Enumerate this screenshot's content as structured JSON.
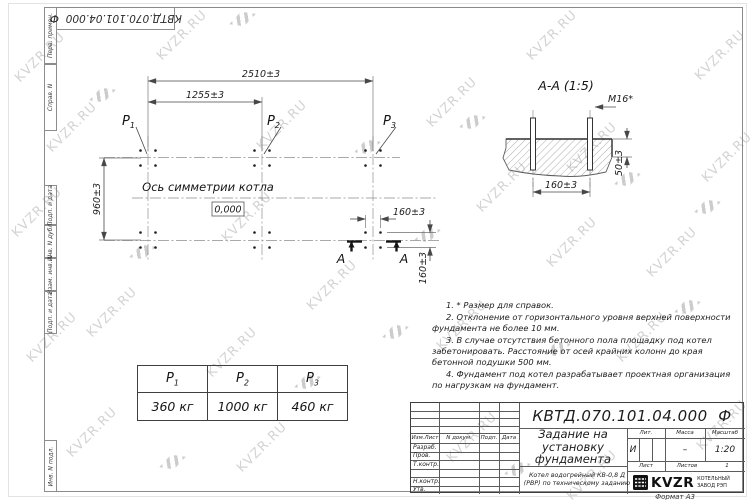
{
  "document": {
    "doc_number": "КВТД.070.101.04.000  Ф",
    "format_label": "Формат А3"
  },
  "watermark": {
    "text": "KVZR.RU"
  },
  "frame": {
    "labels": [
      "Перв. примен.",
      "Справ. N",
      "Подп. и дата",
      "Инв. N дубл.",
      "Взам. инв. N",
      "Подп. и дата",
      "Инв. N подл."
    ]
  },
  "plan": {
    "dim_width_total": "2510±3",
    "dim_width_half": "1255±3",
    "dim_height": "960±3",
    "dim_bolt_h": "160±3",
    "dim_bolt_v": "160±3",
    "axis_label": "Ось симметрии котла",
    "level_mark": "0,000",
    "section_letter": "А",
    "points": [
      {
        "base": "P",
        "sub": "1"
      },
      {
        "base": "P",
        "sub": "2"
      },
      {
        "base": "P",
        "sub": "3"
      }
    ]
  },
  "section_view": {
    "title": "А-А (1:5)",
    "thread_label": "M16*",
    "dim_protrusion": "50±3",
    "dim_spacing": "160±3"
  },
  "notes": [
    "1. * Размер для справок.",
    "2. Отклонение от горизонтального уровня верхней поверхности фундамента не более 10 мм.",
    "3. В случае отсутствия бетонного пола площадку под котел забетонировать. Расстояние от осей крайних колонн до края бетонной подушки 500 мм.",
    "4. Фундамент под котел разрабатывает проектная организация по нагрузкам на фундамент."
  ],
  "load_table": {
    "headers": [
      {
        "base": "P",
        "sub": "1"
      },
      {
        "base": "P",
        "sub": "2"
      },
      {
        "base": "P",
        "sub": "3"
      }
    ],
    "values": [
      "360 кг",
      "1000 кг",
      "460 кг"
    ]
  },
  "title_block": {
    "title": "Задание на установку фундамента",
    "subtitle": "Котел водогрейный КВ-0,8 Д (РВР) по техническому заданию",
    "header_cols": [
      "Изм.Лист",
      "N докум.",
      "Подп.",
      "Дата"
    ],
    "sign_rows": [
      "Разраб.",
      "Пров.",
      "Т.контр.",
      "",
      "Н.контр.",
      "Утв."
    ],
    "lit_label": "Лит.",
    "lit_value": "И",
    "mass_label": "Масса",
    "mass_value": "–",
    "scale_label": "Масштаб",
    "scale_value": "1:20",
    "sheet_label": "Лист",
    "sheets_label": "Листов",
    "sheets_value": "1",
    "logo_text": "KVZR",
    "logo_caption": "КОТЕЛЬНЫЙ ЗАВОД РЭП"
  }
}
